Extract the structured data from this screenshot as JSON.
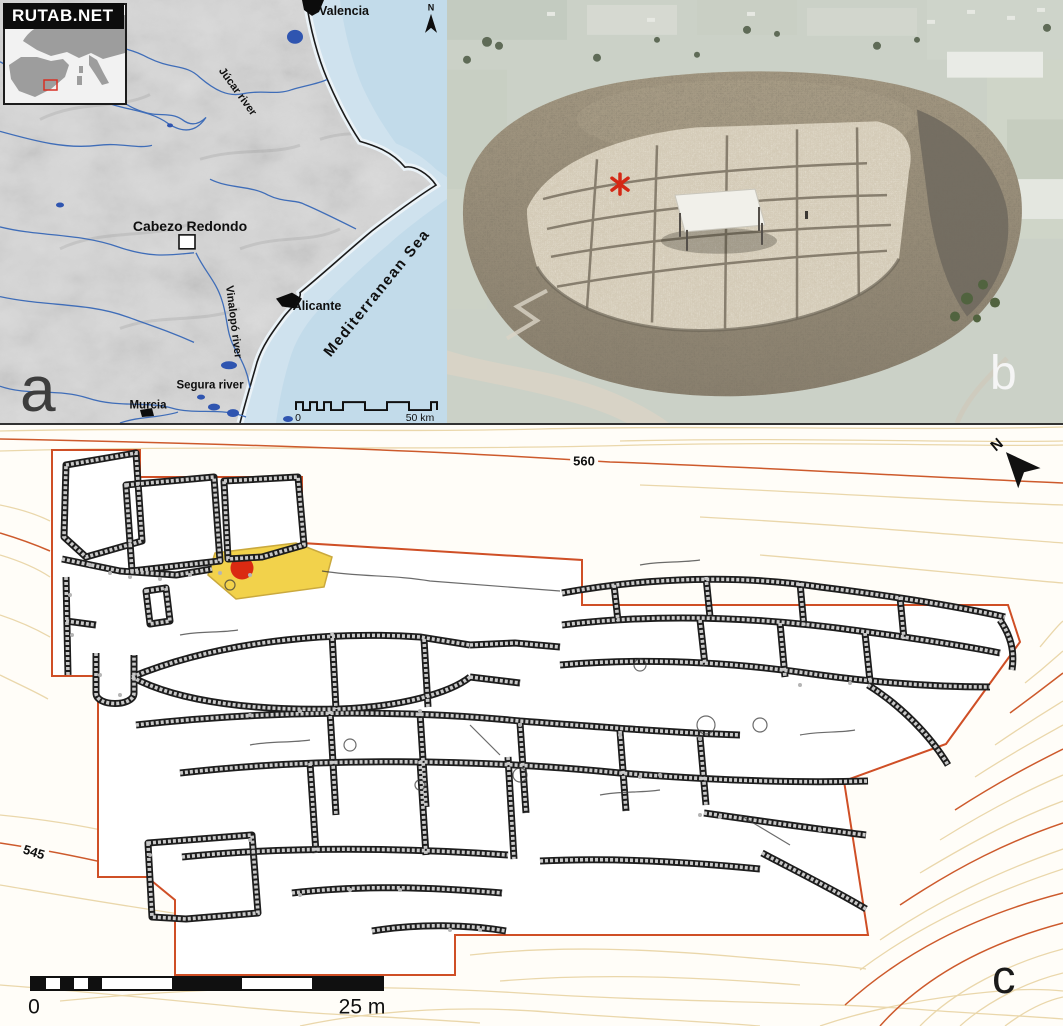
{
  "watermark": {
    "text": "RUTAB.NET"
  },
  "panels": {
    "a": {
      "letter": "a",
      "north": "N",
      "place_labels": {
        "valencia": "Valencia",
        "jucar": "Júcar river",
        "cabezo": "Cabezo Redondo",
        "vinalopo": "Vinalopó river",
        "alicante": "Alicante",
        "mediterranean": "Mediterranean Sea",
        "segura": "Segura river",
        "murcia": "Murcia"
      },
      "scalebar": {
        "zero": "0",
        "max": "50 km"
      }
    },
    "b": {
      "letter": "b"
    },
    "c": {
      "letter": "c",
      "north": "N",
      "contour_labels": {
        "c560": "560",
        "c545": "545"
      },
      "scalebar": {
        "zero": "0",
        "max": "25 m"
      }
    }
  },
  "colors": {
    "boundary_orange": "#cf4f26",
    "contour_tan": "#ead7ab",
    "trench_yellow": "#f2d24b",
    "marker_red": "#da2a12",
    "sea_blue": "#cfe2ee",
    "river_blue": "#3f6db8"
  }
}
